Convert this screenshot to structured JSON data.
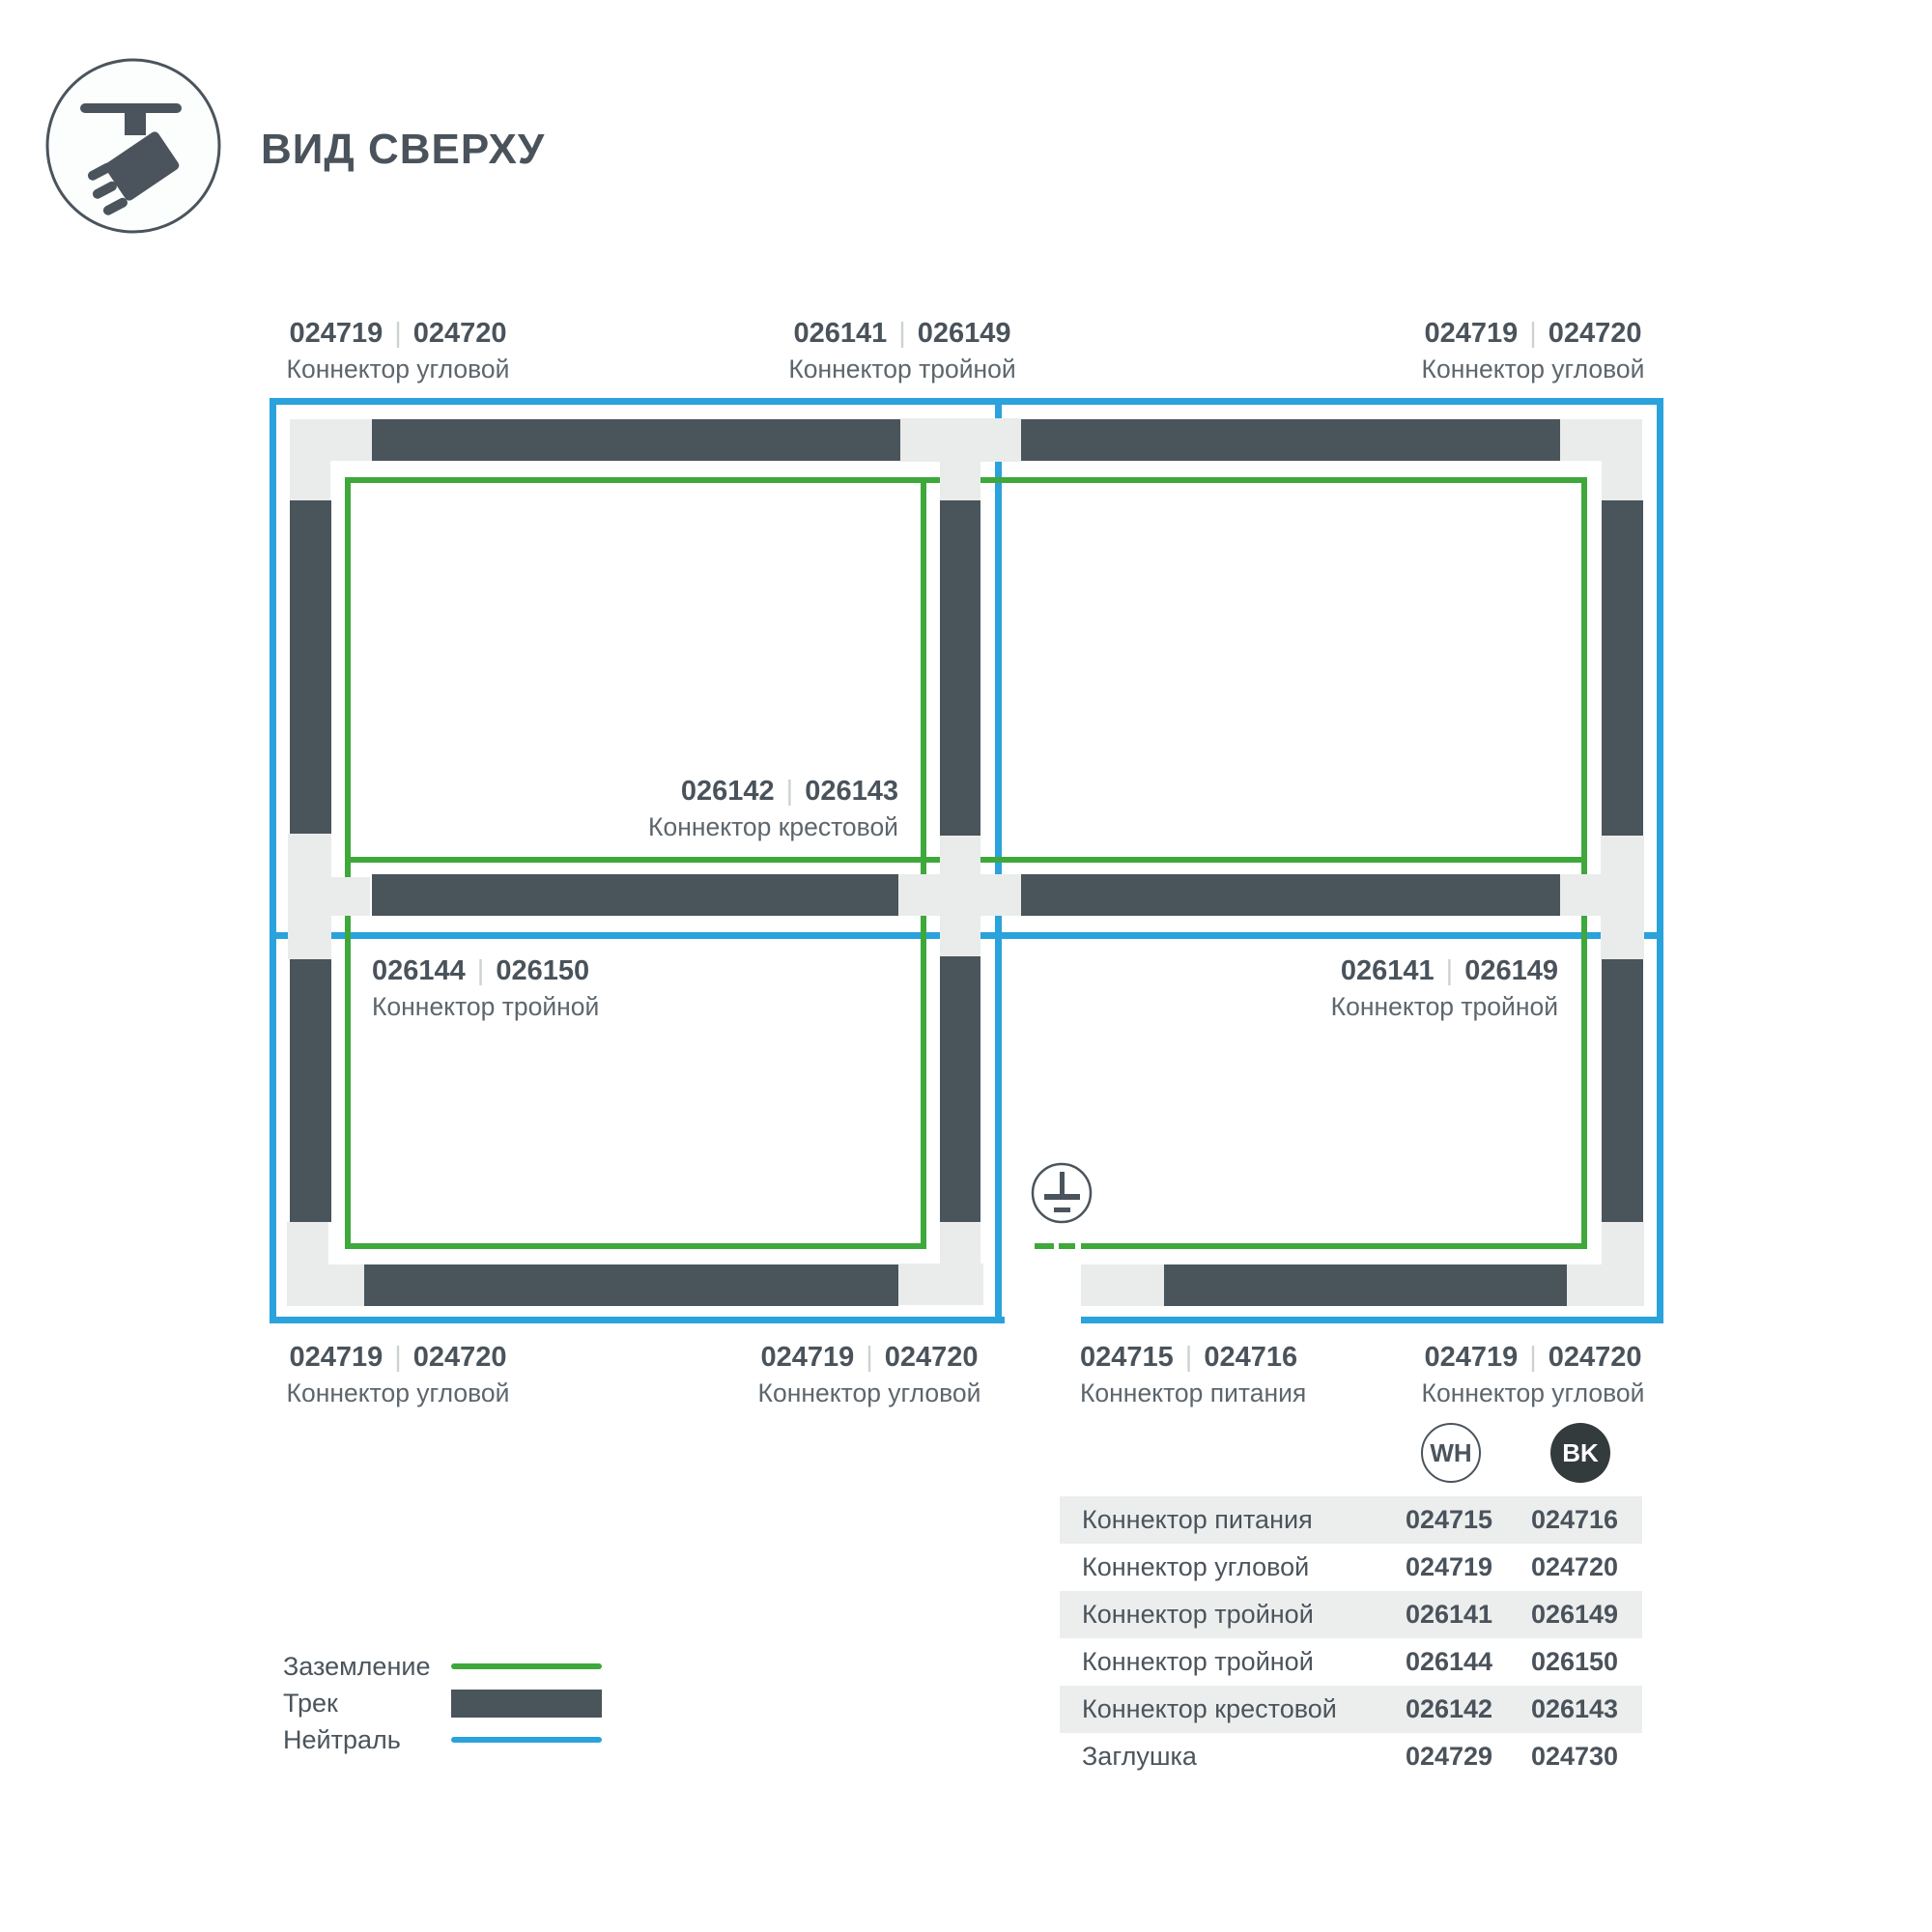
{
  "header": {
    "title": "ВИД СВЕРХУ",
    "icon": "track-spotlight-icon"
  },
  "diagram": {
    "separator": "|",
    "labels": {
      "top_left": {
        "code_wh": "024719",
        "code_bk": "024720",
        "name": "Коннектор угловой"
      },
      "top_middle": {
        "code_wh": "026141",
        "code_bk": "026149",
        "name": "Коннектор тройной"
      },
      "top_right": {
        "code_wh": "024719",
        "code_bk": "024720",
        "name": "Коннектор угловой"
      },
      "cross": {
        "code_wh": "026142",
        "code_bk": "026143",
        "name": "Коннектор крестовой"
      },
      "mid_left": {
        "code_wh": "026144",
        "code_bk": "026150",
        "name": "Коннектор тройной"
      },
      "mid_right": {
        "code_wh": "026141",
        "code_bk": "026149",
        "name": "Коннектор тройной"
      },
      "bottom_left": {
        "code_wh": "024719",
        "code_bk": "024720",
        "name": "Коннектор угловой"
      },
      "bottom_center": {
        "code_wh": "024719",
        "code_bk": "024720",
        "name": "Коннектор угловой"
      },
      "bottom_power": {
        "code_wh": "024715",
        "code_bk": "024716",
        "name": "Коннектор питания"
      },
      "bottom_right": {
        "code_wh": "024719",
        "code_bk": "024720",
        "name": "Коннектор угловой"
      }
    }
  },
  "legend": {
    "items": [
      {
        "label": "Заземление",
        "swatch": "green-line"
      },
      {
        "label": "Трек",
        "swatch": "track-bar"
      },
      {
        "label": "Нейтраль",
        "swatch": "blue-line"
      }
    ]
  },
  "table": {
    "columns": [
      {
        "code": "WH"
      },
      {
        "code": "BK"
      }
    ],
    "rows": [
      {
        "name": "Коннектор питания",
        "wh": "024715",
        "bk": "024716"
      },
      {
        "name": "Коннектор угловой",
        "wh": "024719",
        "bk": "024720"
      },
      {
        "name": "Коннектор тройной",
        "wh": "026141",
        "bk": "026149"
      },
      {
        "name": "Коннектор тройной",
        "wh": "026144",
        "bk": "026150"
      },
      {
        "name": "Коннектор крестовой",
        "wh": "026142",
        "bk": "026143"
      },
      {
        "name": "Заглушка",
        "wh": "024729",
        "bk": "024730"
      }
    ]
  },
  "colors": {
    "track": "#4a545b",
    "connector": "#e9eceb",
    "ground_green": "#3ea83b",
    "neutral_blue": "#2aa2db",
    "row_stripe": "#eceeee",
    "text_dark": "#4a535b",
    "text_gray": "#5d666c"
  }
}
